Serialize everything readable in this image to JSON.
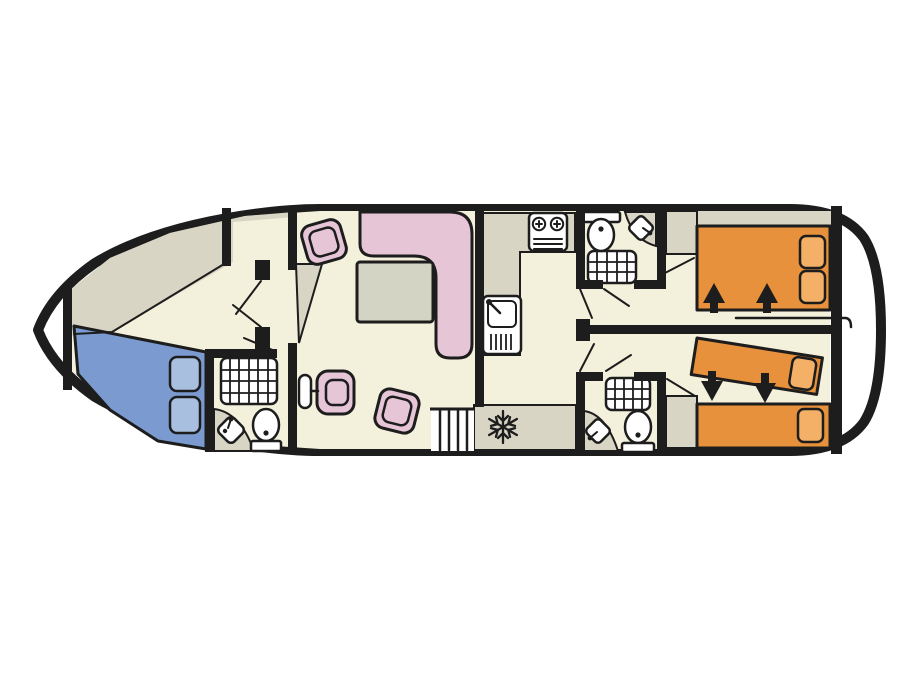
{
  "type": "boat-deck-floor-plan",
  "colors": {
    "wall": "#1d1d1d",
    "hull_fill": "#ffffff",
    "floor": "#f3f0dc",
    "deck": "#d8d5c4",
    "white": "#ffffff",
    "bed_blue": "#7b9bd0",
    "pillow_blue": "#a8bfe0",
    "pink": "#e5c5d6",
    "table_gray": "#d4d4c4",
    "bed_orange": "#e8913c",
    "pillow_orange": "#f3b066"
  },
  "icons": {
    "fridge": "snowflake-icon",
    "bed_slide_direction": "arrow-icon"
  },
  "rooms": [
    {
      "name": "bow cabin",
      "features": [
        "double bed",
        "deck locker"
      ]
    },
    {
      "name": "bow bathroom",
      "features": [
        "shower",
        "corner washbasin",
        "toilet"
      ]
    },
    {
      "name": "saloon",
      "features": [
        "L-shaped sofa",
        "table",
        "2 chairs",
        "helm seat",
        "steering wheel",
        "stairs"
      ]
    },
    {
      "name": "galley",
      "features": [
        "hob",
        "sink",
        "fridge"
      ]
    },
    {
      "name": "mid bathroom top",
      "features": [
        "toilet",
        "corner washbasin",
        "shower"
      ]
    },
    {
      "name": "mid bathroom bottom",
      "features": [
        "shower",
        "corner washbasin",
        "toilet"
      ]
    },
    {
      "name": "aft cabin top",
      "features": [
        "double bed",
        "wardrobe",
        "grab rail"
      ]
    },
    {
      "name": "aft cabin bottom",
      "features": [
        "two single beds",
        "wardrobe"
      ]
    }
  ]
}
